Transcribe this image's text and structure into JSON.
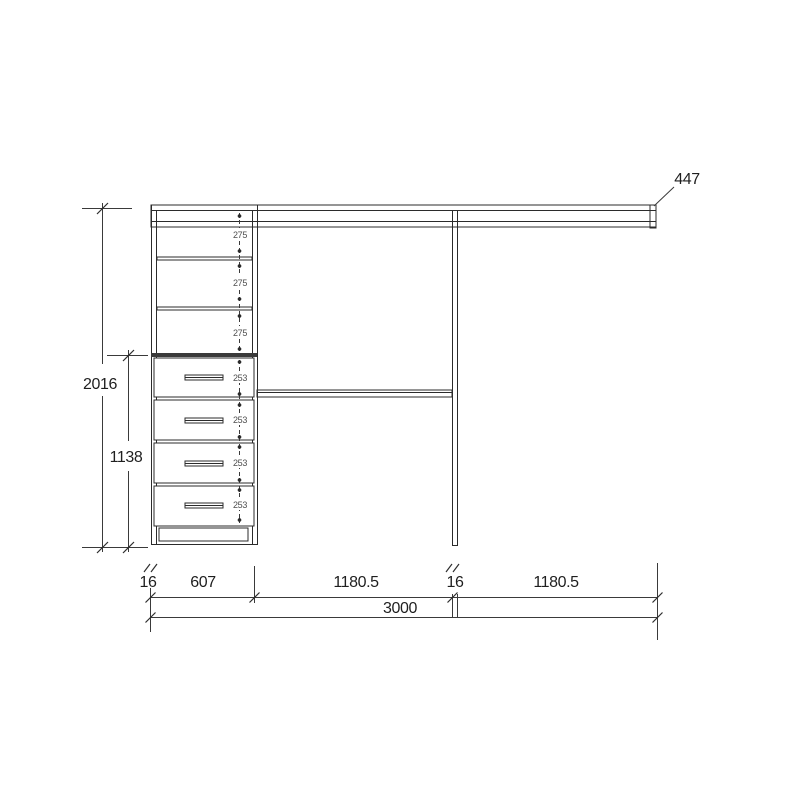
{
  "diagram": {
    "type": "wardrobe-closet-elevation",
    "colors": {
      "line": "#2b2b2b",
      "dimension_line": "#3a3a3a",
      "label": "#1f1f1f",
      "small_label": "#4f4f4f",
      "background": "#ffffff"
    },
    "dims": {
      "total_height": "2016",
      "drawer_stack_height": "1138",
      "top_shelf_depth": "447",
      "shelf_gaps": [
        "275",
        "275",
        "275"
      ],
      "drawer_heights": [
        "253",
        "253",
        "253",
        "253"
      ],
      "width_segments": [
        "16",
        "607",
        "1180.5",
        "16",
        "1180.5"
      ],
      "total_width": "3000"
    }
  }
}
